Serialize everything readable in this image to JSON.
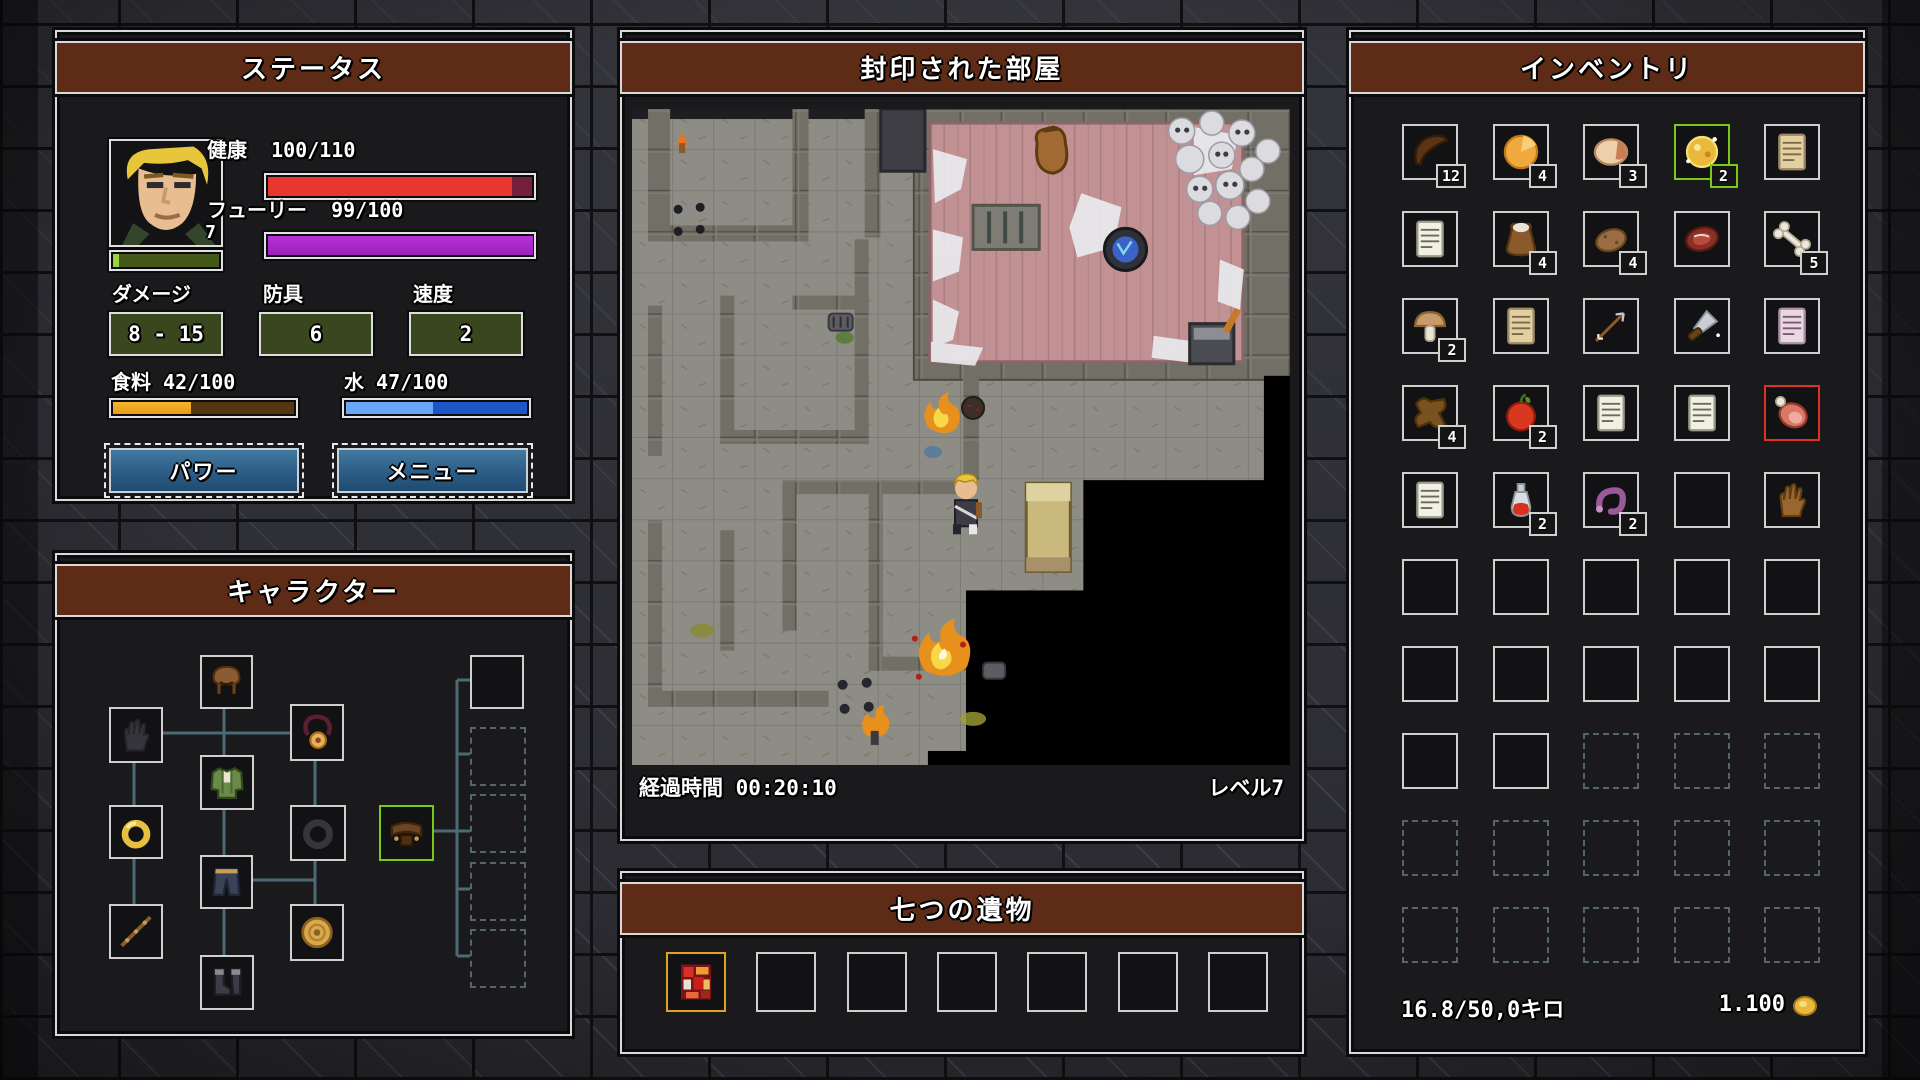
{
  "status_panel": {
    "title": "ステータス",
    "portrait_level": "7",
    "health_label": "健康",
    "health_value": "100/110",
    "health_pct": 91,
    "fury_label": "フューリー",
    "fury_value": "99/100",
    "fury_pct": 99,
    "xp_pct": 5,
    "damage_label": "ダメージ",
    "damage_value": "8 - 15",
    "armor_label": "防具",
    "armor_value": "6",
    "speed_label": "速度",
    "speed_value": "2",
    "food_label": "食料",
    "food_value": "42/100",
    "food_pct": 42,
    "water_label": "水",
    "water_value": "47/100",
    "water_pct": 47,
    "power_button": "パワー",
    "menu_button": "メニュー",
    "colors": {
      "health": "#e8372c",
      "health_missing": "#75203a",
      "fury": "#bb2fd8",
      "xp": "#9ad33c",
      "xp_rest": "#43581a",
      "food": "#e99a16",
      "food_rest": "#553510",
      "water": "#6aa7f8",
      "water_rest": "#1e56c8"
    }
  },
  "character_panel": {
    "title": "キャラクター",
    "slots": [
      {
        "name": "hood-slot",
        "item": "hood",
        "state": "filled"
      },
      {
        "name": "gloves-slot",
        "item": "glove-empty",
        "state": "empty"
      },
      {
        "name": "amulet-slot",
        "item": "amulet",
        "state": "filled"
      },
      {
        "name": "armor-slot",
        "item": "tunic",
        "state": "filled"
      },
      {
        "name": "ring-left-slot",
        "item": "ring-gold",
        "state": "filled"
      },
      {
        "name": "ring-right-slot",
        "item": "ring-empty",
        "state": "empty"
      },
      {
        "name": "belt-slot",
        "item": "belt",
        "state": "selected",
        "style": "green"
      },
      {
        "name": "pants-slot",
        "item": "pants",
        "state": "filled"
      },
      {
        "name": "weapon-slot",
        "item": "staff",
        "state": "filled"
      },
      {
        "name": "shield-slot",
        "item": "shield",
        "state": "filled"
      },
      {
        "name": "boots-slot",
        "item": "boots",
        "state": "filled"
      },
      {
        "name": "extra-slot-1",
        "item": "",
        "state": "empty"
      },
      {
        "name": "extra-slot-2",
        "item": "",
        "state": "empty",
        "style": "dashed"
      },
      {
        "name": "extra-slot-3",
        "item": "",
        "state": "empty",
        "style": "dashed"
      },
      {
        "name": "extra-slot-4",
        "item": "",
        "state": "empty",
        "style": "dashed"
      },
      {
        "name": "extra-slot-5",
        "item": "",
        "state": "empty",
        "style": "dashed"
      }
    ]
  },
  "map_panel": {
    "title": "封印された部屋",
    "elapsed_label": "経過時間",
    "elapsed_value": "00:20:10",
    "level_text": "レベル7",
    "entities": [
      "player",
      "skull-pile",
      "loot-sack",
      "blue-seal",
      "anvil",
      "bed",
      "fire",
      "explosion",
      "torch",
      "spider-webs",
      "unexplored-darkness"
    ]
  },
  "relic_panel": {
    "title": "七つの遺物",
    "slots": [
      {
        "name": "relic-slot-1",
        "item": "relic",
        "style": "gold"
      },
      {
        "name": "relic-slot-2",
        "item": ""
      },
      {
        "name": "relic-slot-3",
        "item": ""
      },
      {
        "name": "relic-slot-4",
        "item": ""
      },
      {
        "name": "relic-slot-5",
        "item": ""
      },
      {
        "name": "relic-slot-6",
        "item": ""
      },
      {
        "name": "relic-slot-7",
        "item": ""
      }
    ]
  },
  "inventory_panel": {
    "title": "インベントリ",
    "weight_text": "16.8/50,0キロ",
    "gold_text": "1.100",
    "grid": [
      [
        {
          "item": "jerky",
          "count": "12"
        },
        {
          "item": "cheese",
          "count": "4"
        },
        {
          "item": "bread",
          "count": "3"
        },
        {
          "item": "goldfood",
          "count": "2",
          "style": "green"
        },
        {
          "item": "scroll-tan"
        }
      ],
      [
        {
          "item": "scroll-white"
        },
        {
          "item": "saltbag",
          "count": "4"
        },
        {
          "item": "potato",
          "count": "4"
        },
        {
          "item": "steak"
        },
        {
          "item": "bone",
          "count": "5"
        }
      ],
      [
        {
          "item": "mushroom",
          "count": "2"
        },
        {
          "item": "scroll-tan"
        },
        {
          "item": "arrow"
        },
        {
          "item": "dagger"
        },
        {
          "item": "scroll-pink"
        }
      ],
      [
        {
          "item": "hide",
          "count": "4"
        },
        {
          "item": "apple",
          "count": "2"
        },
        {
          "item": "scroll-white"
        },
        {
          "item": "scroll-white"
        },
        {
          "item": "ham",
          "style": "red"
        }
      ],
      [
        {
          "item": "scroll-white"
        },
        {
          "item": "potion",
          "count": "2"
        },
        {
          "item": "worm",
          "count": "2"
        },
        {},
        {
          "item": "glove"
        }
      ],
      [
        {},
        {},
        {},
        {},
        {}
      ],
      [
        {},
        {},
        {},
        {},
        {}
      ],
      [
        {},
        {},
        {
          "style": "dashed"
        },
        {
          "style": "dashed"
        },
        {
          "style": "dashed"
        }
      ],
      [
        {
          "style": "dashed"
        },
        {
          "style": "dashed"
        },
        {
          "style": "dashed"
        },
        {
          "style": "dashed"
        },
        {
          "style": "dashed"
        }
      ],
      [
        {
          "style": "dashed"
        },
        {
          "style": "dashed"
        },
        {
          "style": "dashed"
        },
        {
          "style": "dashed"
        },
        {
          "style": "dashed"
        }
      ]
    ]
  }
}
